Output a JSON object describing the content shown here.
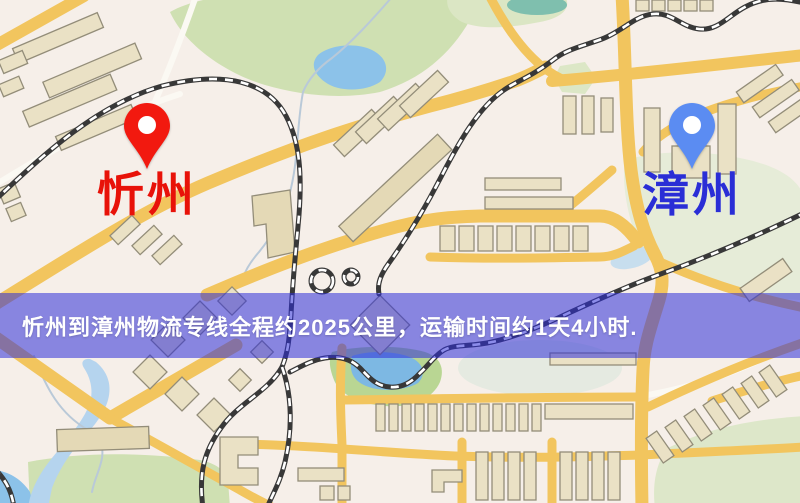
{
  "banner": {
    "text": "忻州到漳州物流专线全程约2025公里，运输时间约1天4小时.",
    "background": "rgba(45,45,216,0.55)",
    "text_color": "#ffffff"
  },
  "markers": {
    "origin": {
      "label": "忻州",
      "pin_color": "#f2190f",
      "label_color": "#e81209"
    },
    "destination": {
      "label": "漳州",
      "pin_color": "#5b8cf2",
      "label_color": "#2a2ed6"
    }
  },
  "map_palette": {
    "background": "#f6efe9",
    "road_major": "#f2c55e",
    "building_fill": "#eae1c5",
    "building_stroke": "#938d79",
    "park_green": "#cfe0b2",
    "water_blue": "#8cc2e9",
    "railway": "#383838"
  }
}
